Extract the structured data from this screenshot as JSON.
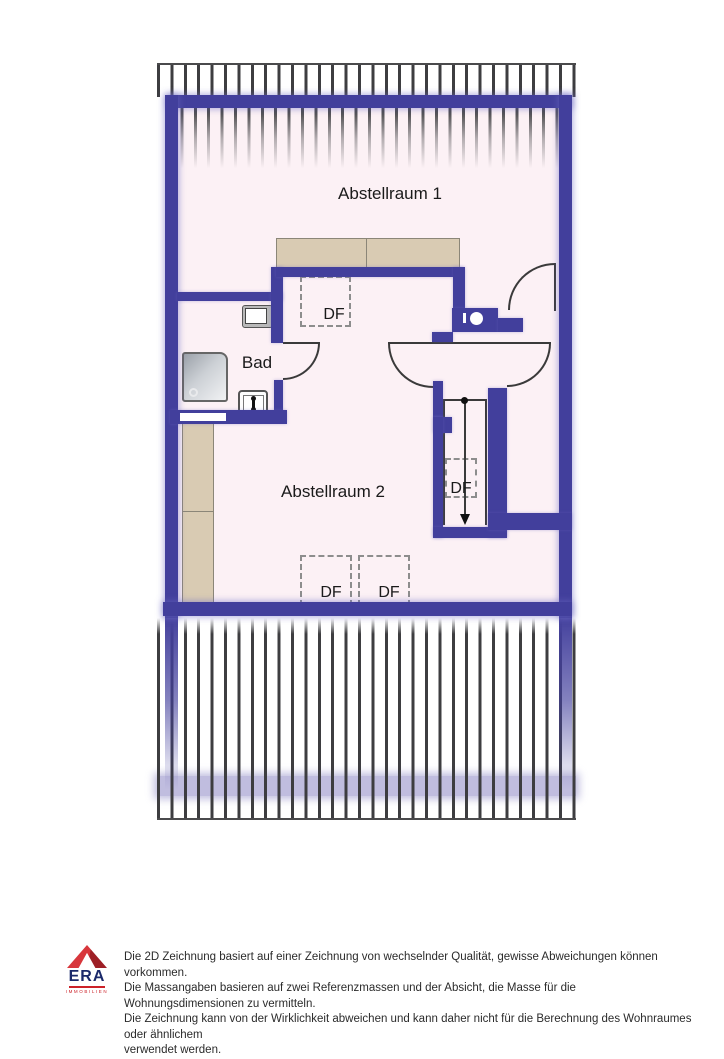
{
  "plan": {
    "rooms": {
      "room1_label": "Abstellraum 1",
      "bathroom_label": "Bad",
      "room2_label": "Abstellraum 2"
    },
    "skylight_label": "DF",
    "colors": {
      "wall": "#423f9c",
      "floor": "#fcf1f5",
      "furniture_tan": "#d9cbb3",
      "hatch_stripe": "#3d3d40",
      "door_line": "#3a3a3a"
    }
  },
  "footer": {
    "logo": {
      "brand": "ERA",
      "subbrand": "IMMOBILIEN",
      "roof_red": "#d8373c",
      "navy": "#1b2a6b"
    },
    "disclaimer": {
      "line1": "Die 2D Zeichnung basiert auf einer Zeichnung von wechselnder Qualität, gewisse Abweichungen können vorkommen.",
      "line2": "Die Massangaben basieren auf zwei Referenzmassen und der Absicht, die Masse für die Wohnungsdimensionen zu vermitteln.",
      "line3": "Die Zeichnung kann von der Wirklichkeit abweichen und kann daher nicht für die Berechnung des Wohnraumes oder ähnlichem",
      "line4": "verwendet werden."
    }
  }
}
